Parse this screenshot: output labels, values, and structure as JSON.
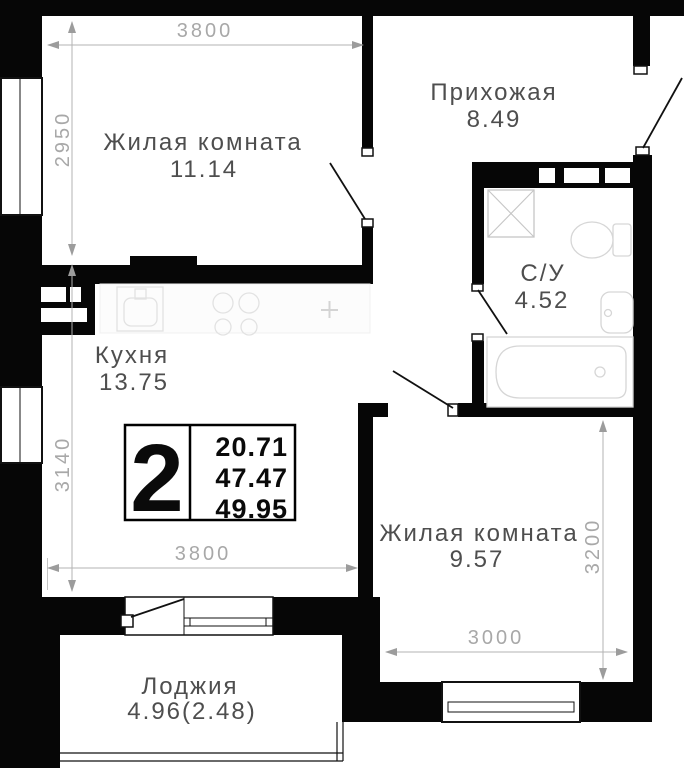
{
  "rooms": [
    {
      "name": "Жилая комната",
      "area": "11.14"
    },
    {
      "name": "Прихожая",
      "area": "8.49"
    },
    {
      "name": "С/У",
      "area": "4.52"
    },
    {
      "name": "Кухня",
      "area": "13.75"
    },
    {
      "name": "Жилая комната",
      "area": "9.57"
    },
    {
      "name": "Лоджия",
      "area": "4.96(2.48)"
    }
  ],
  "info_badge": {
    "room_count": "2",
    "areas": [
      "20.71",
      "47.47",
      "49.95"
    ]
  },
  "dimensions_mm": {
    "top_width": "3800",
    "left_height_upper": "2950",
    "left_height_lower": "3140",
    "bottom_width": "3800",
    "right_height": "3200",
    "bottom_right_width": "3000"
  },
  "colors": {
    "wall": "#060606",
    "dimension": "#a8a8a8",
    "room_label": "#4e4e4e",
    "fixture_outline": "#d6d6d6"
  }
}
